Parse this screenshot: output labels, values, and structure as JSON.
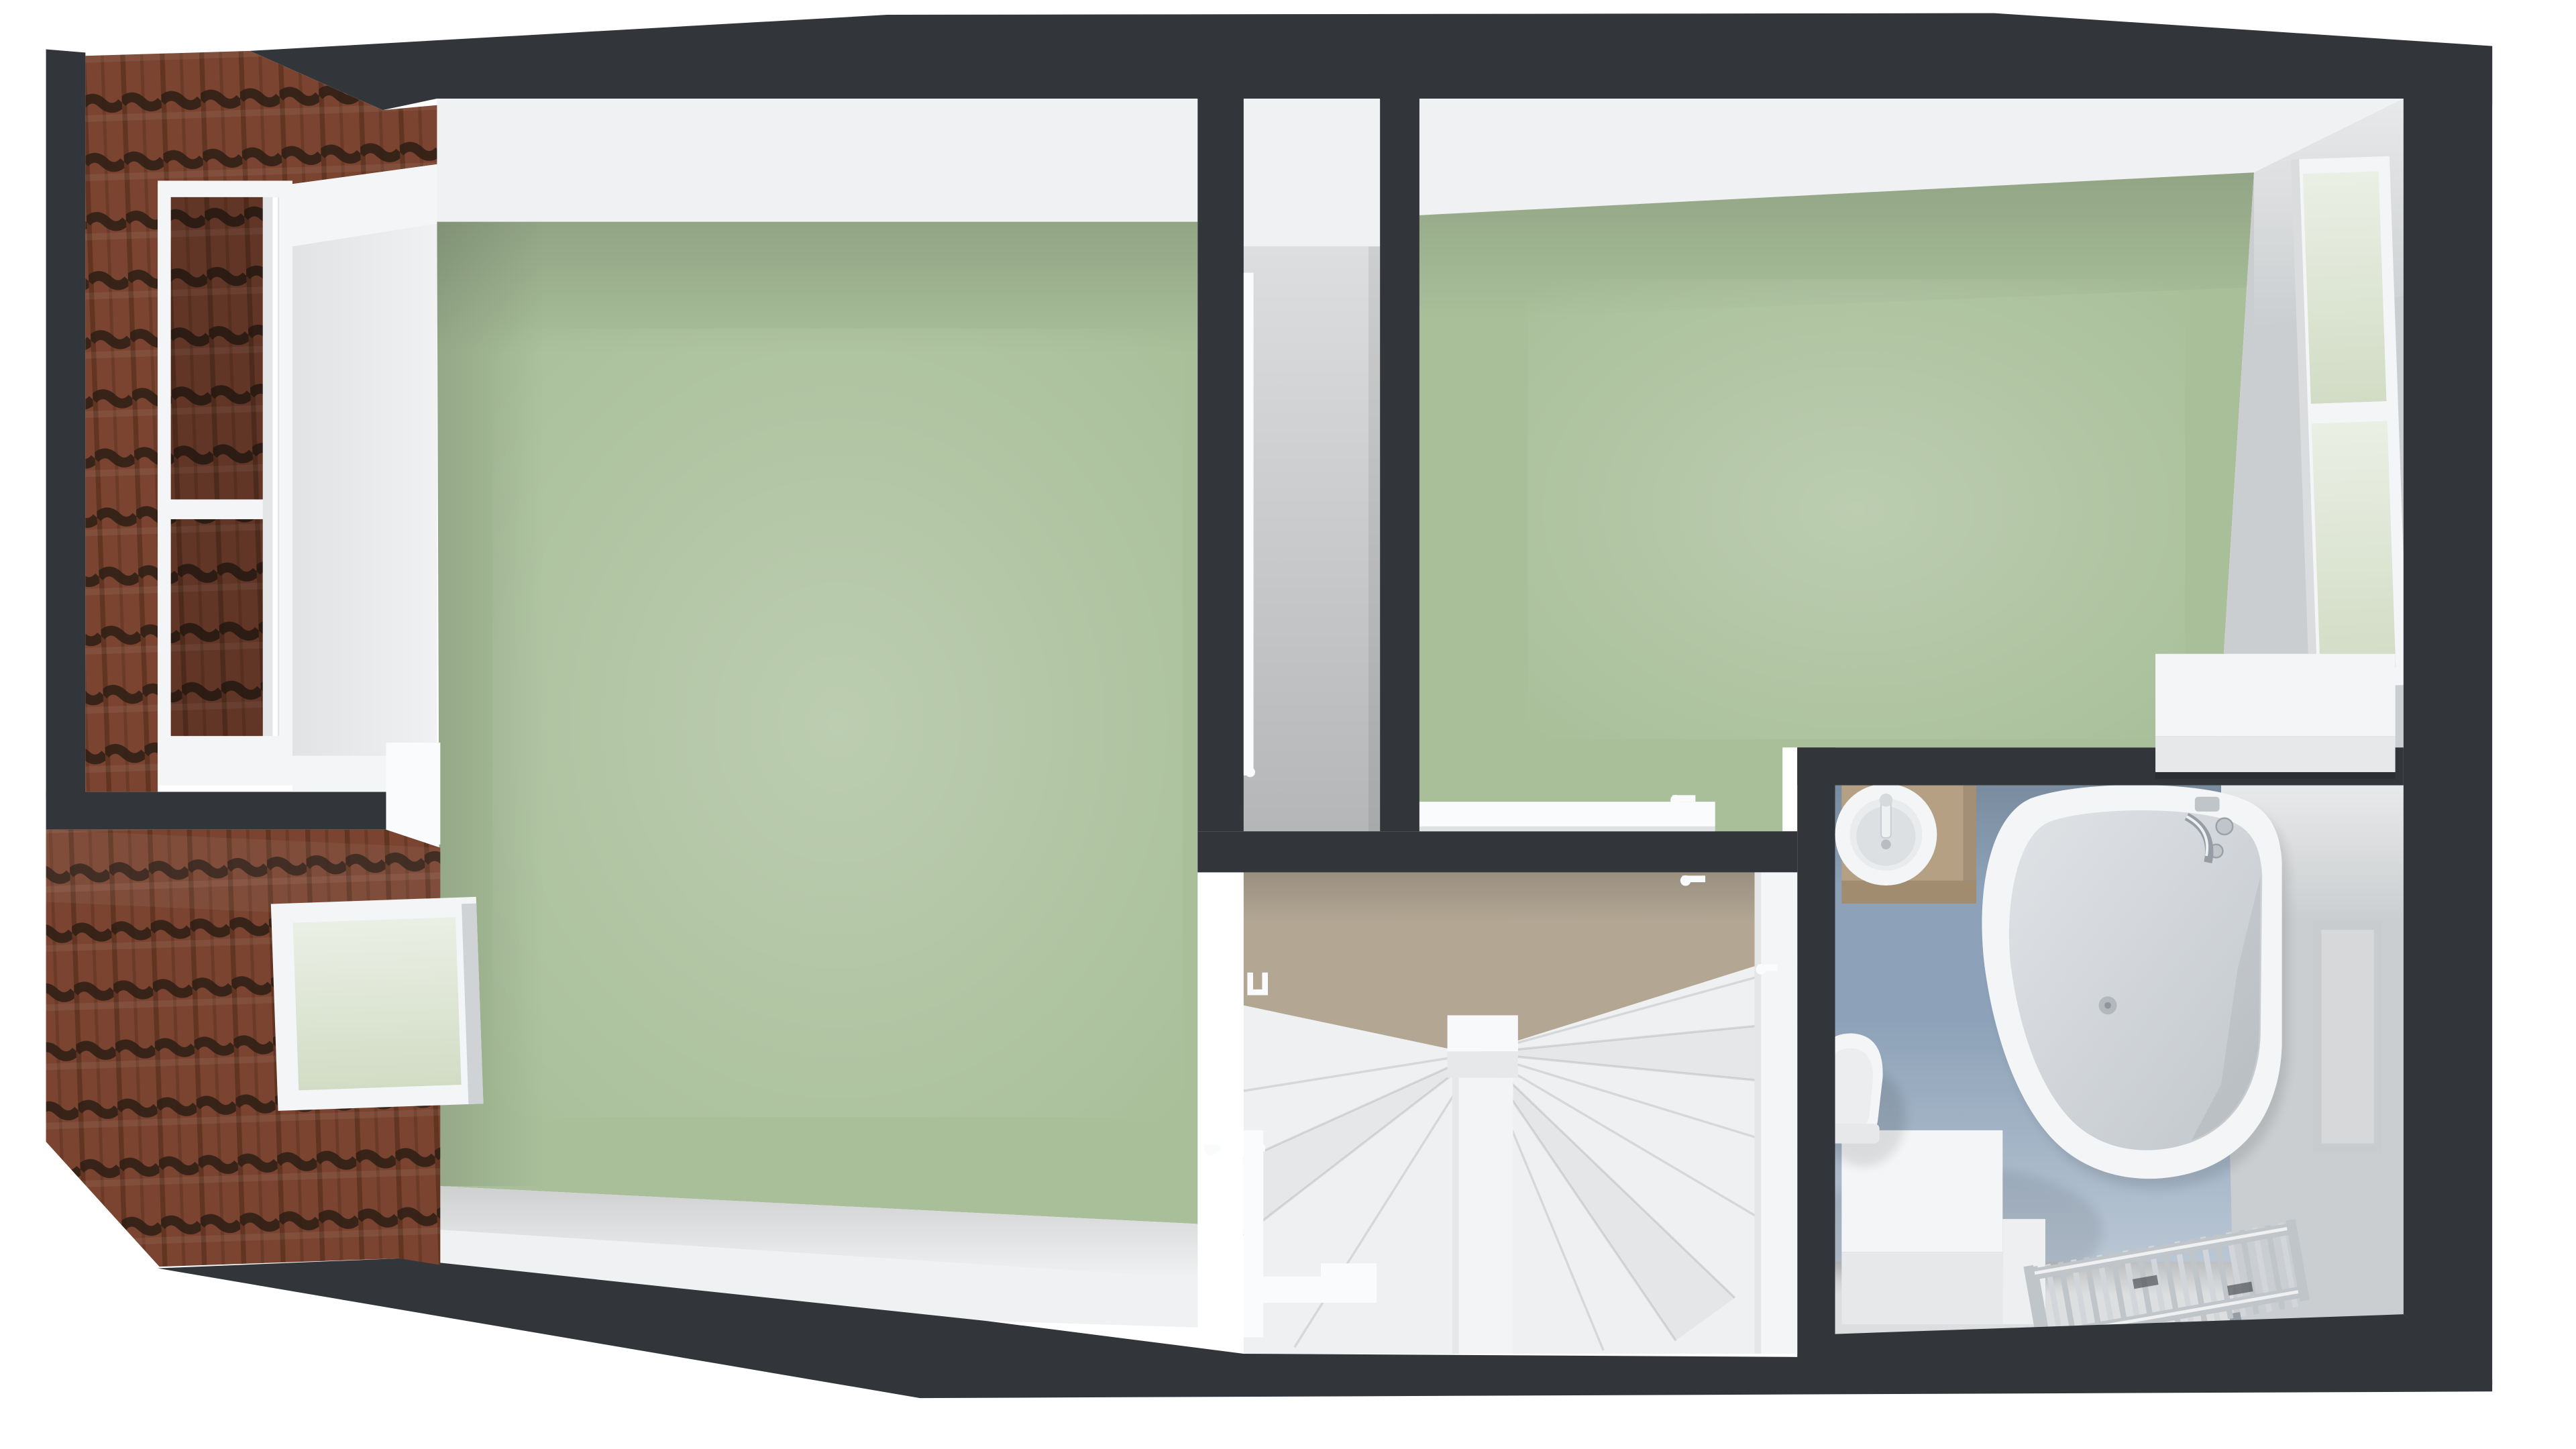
{
  "scene": {
    "type": "top-down 3D dollhouse floor-plan render",
    "objects": [
      "tiled roof slope",
      "dormer window",
      "roof window skylight",
      "left bedroom with green carpet",
      "narrow closet corridor",
      "right bedroom with green carpet",
      "east wall window",
      "low white cabinet",
      "stair landing",
      "winder staircase with newel post",
      "handrail",
      "interior door leaves with handles",
      "bathroom with blue floor",
      "washbasin vanity with round sink",
      "toilet",
      "corner bathtub",
      "bath mixer tap",
      "chrome towel radiator",
      "boxed platform"
    ]
  },
  "colors": {
    "background": "#ffffff",
    "outer_wall": "#323539",
    "roof_tile_base": "#7a4431",
    "roof_tile_rib": "#5d3220",
    "roof_tile_groove": "#311f16",
    "wall_face_white": "#f0f1f2",
    "wall_face_shadow": "#dcdee0",
    "wall_gray": "#cbced0",
    "floor_green": "#a9bf9a",
    "floor_gray": "#b4b6b8",
    "floor_taupe": "#b3a794",
    "floor_blue": "#8da2b8",
    "stairs_white": "#eef0f1",
    "stair_line": "#d3d5d7",
    "fixture_white": "#f4f5f6",
    "fixture_shadow": "#e6e8ea",
    "vanity_top": "#b5a083",
    "vanity_front": "#a18c6f",
    "tub_interior": "#e0e3e6",
    "tub_interior_deep": "#c2c7cc",
    "chrome": "#c0c5ca",
    "chrome_dark": "#969da4",
    "glass_green": "#d2dcc5",
    "niche_gray": "#c9ccce",
    "handle_white": "#fafbfc"
  }
}
